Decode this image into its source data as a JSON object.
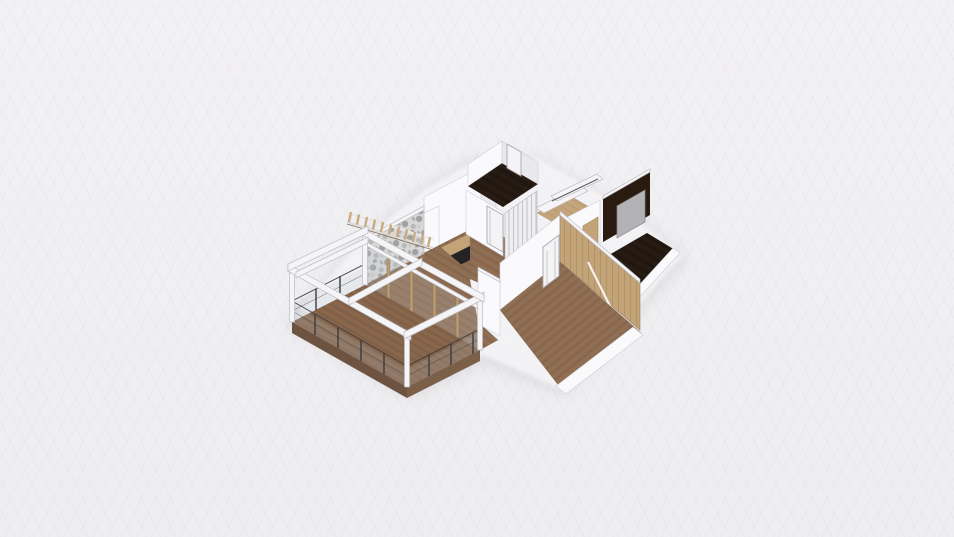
{
  "app": {
    "name": "3D floor plan viewer",
    "view_mode": "3d-perspective-render"
  },
  "canvas": {
    "width": 954,
    "height": 537
  },
  "colors": {
    "background_top": "#f2f1f3",
    "background_bottom": "#eeedf0",
    "grid_line": "rgba(120,120,135,0.045)",
    "ground": "#f7f6f8",
    "shadow": "rgba(70,62,55,0.10)",
    "wall": "#fafafc",
    "wall_shade": "#e9e9ec",
    "wall_outline": "#cfcfd4",
    "wood_floor": "#8d6c51",
    "wood_plank_line": "#755640",
    "wood_deck": "#85644a",
    "deck_fascia": "#6d5340",
    "tan_floor": "#c4a47b",
    "tan_line": "#a98a62",
    "dark_floor": "#241a12",
    "dark_wall": "#2a1b10",
    "marble_base": "#d8d8d8",
    "marble_dark": "#8f8f8f",
    "pergola": "#f5f5f7",
    "pergola_edge": "#bdbdc2",
    "railing": "#3c3b3e",
    "glass": "rgba(185,195,205,0.22)",
    "mullion_tan": "#b89b72",
    "wardrobe_tan": "#c2a478",
    "panel_gray": "#b3b3b6",
    "counter_dark": "#232326",
    "door_white": "#f4f4f6",
    "door_frame": "#a9a9ae",
    "stripe_gray": "#c2c2c7"
  },
  "scene": {
    "objects": [
      {
        "name": "balcony-terrace"
      },
      {
        "name": "wood-deck-floor"
      },
      {
        "name": "glass-balustrade-railing"
      },
      {
        "name": "white-pergola-frame"
      },
      {
        "name": "slatted-pergola-beam"
      },
      {
        "name": "living-room-wood-floor"
      },
      {
        "name": "sliding-glass-door-wall"
      },
      {
        "name": "marble-accent-wall"
      },
      {
        "name": "dark-media-counter"
      },
      {
        "name": "bathroom-dark-floor"
      },
      {
        "name": "striped-sliding-wardrobe"
      },
      {
        "name": "white-interior-door"
      },
      {
        "name": "walk-in-closet-tan-floor"
      },
      {
        "name": "hallway-wood-floor"
      },
      {
        "name": "master-bathroom-dark-wall"
      },
      {
        "name": "glass-shower-panel"
      },
      {
        "name": "bedroom-wood-floor"
      },
      {
        "name": "bedroom-door"
      },
      {
        "name": "mirrored-tan-wardrobe"
      }
    ]
  }
}
